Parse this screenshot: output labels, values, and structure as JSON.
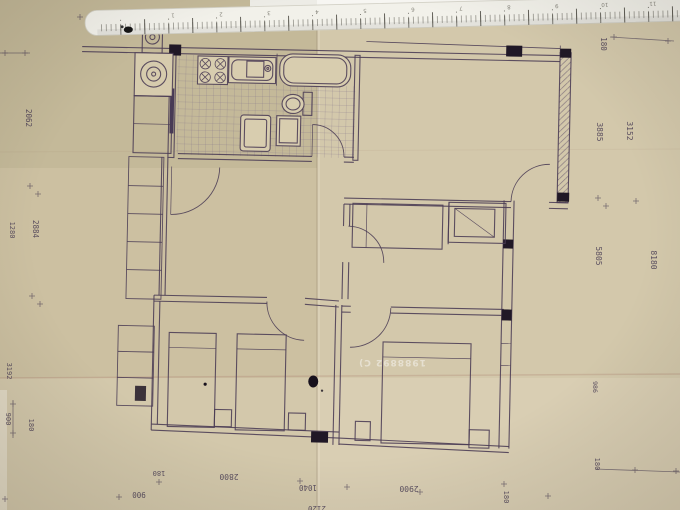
{
  "photo": {
    "description": "Scanned architectural floor plan on aged tan paper, photographed upside-down with a white scale ruler along the top edge",
    "palette": {
      "paper": "#ccc0a1",
      "paper_light": "#d9cdb0",
      "ink_line": "#4a3b54",
      "ink_black": "#201826",
      "ruler_white": "#f2f1ea",
      "photo_bg": "#f7f6f2",
      "crease": "#b0897f"
    }
  },
  "ruler": {
    "marks": [
      "1",
      "2",
      "3",
      "4",
      "5",
      "6",
      "7",
      "8",
      "9",
      "10",
      "11"
    ]
  },
  "dims": {
    "bottom": {
      "b1": "900",
      "b2": "180",
      "b3": "2800",
      "b4": "1040",
      "b5": "2120",
      "b6": "2900",
      "b7": "180",
      "b8": "180"
    },
    "left": {
      "l1": "2062",
      "l2": "1280",
      "l3": "2884",
      "l4": "3192",
      "l5": "900",
      "l6": "180"
    },
    "right": {
      "r1": "180",
      "r2": "3885",
      "r3": "3152",
      "r4": "5805",
      "r5": "8180",
      "r6": "986"
    }
  },
  "watermark": {
    "text": "1988892 C)"
  }
}
